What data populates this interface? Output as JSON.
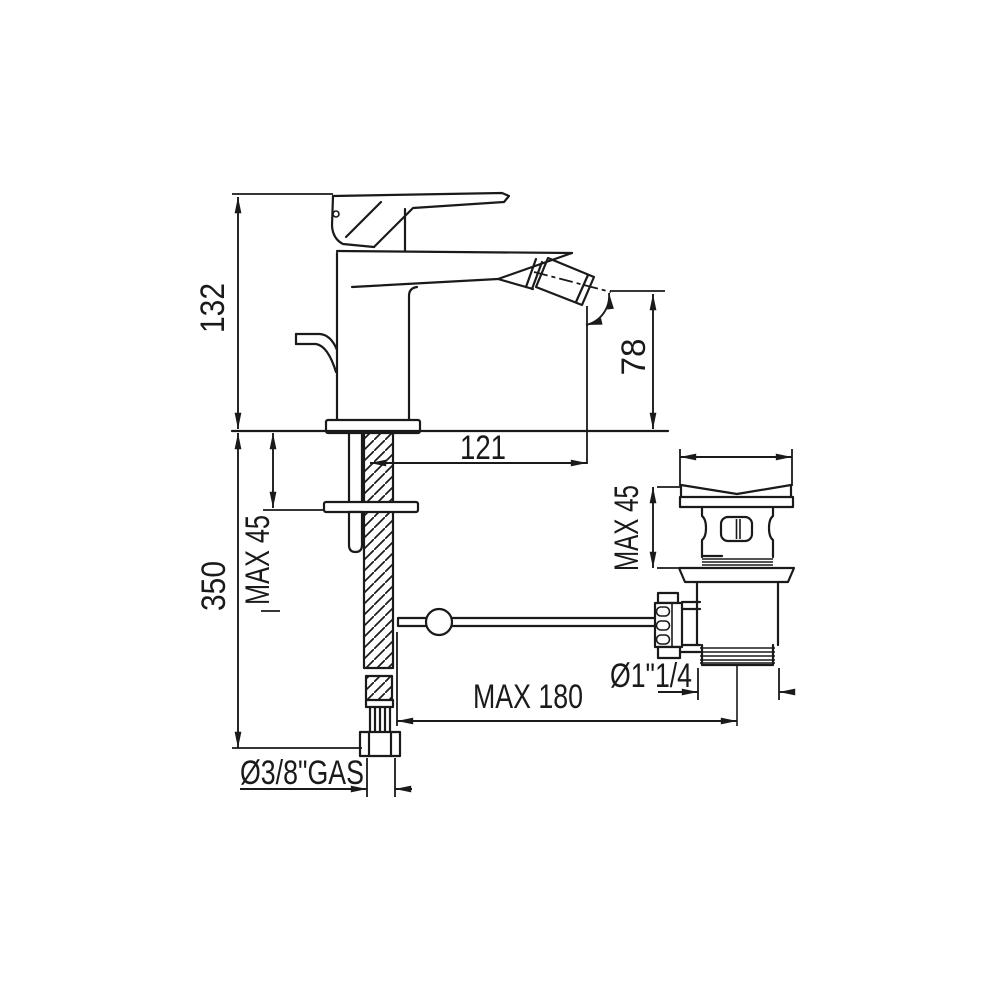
{
  "drawing": {
    "type": "technical-dimension-drawing",
    "subject": "single-lever bidet mixer with pop-up waste drain",
    "labels": {
      "total_height": "132",
      "spout_height": "78",
      "spout_reach": "121",
      "deck_thickness_faucet": "MAX 45",
      "supply_length": "350",
      "deck_thickness_drain": "MAX 45",
      "rod_length": "MAX 180",
      "drain_thread": "Ø1\"1/4",
      "supply_thread": "Ø3/8\"GAS"
    },
    "colors": {
      "line": "#1a1a1a",
      "background": "#ffffff"
    }
  }
}
